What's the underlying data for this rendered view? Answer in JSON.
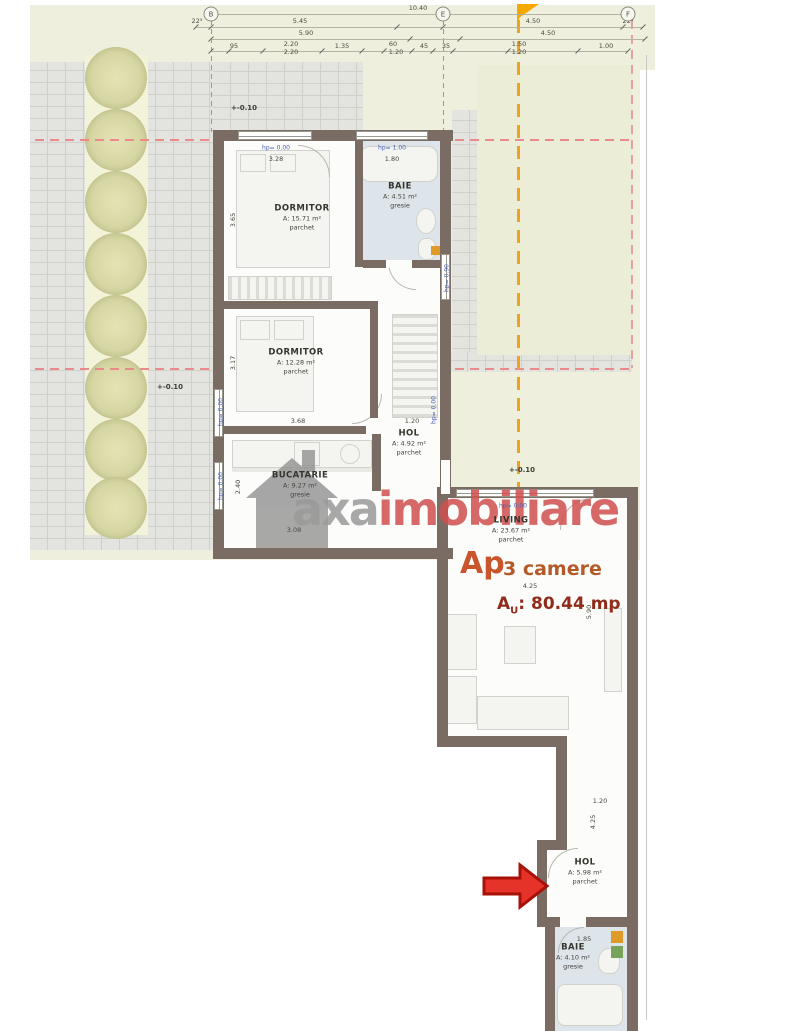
{
  "plan_title": "floor-plan",
  "apartment": {
    "name": "Ap",
    "rooms_count": "3 camere",
    "area_prefix": "A",
    "area_sub": "U",
    "area_value": ": 80.44 mp"
  },
  "watermark": {
    "gray_text": "axa",
    "red_text": "imobiliare"
  },
  "colors": {
    "accent_orange": "#f0a11e",
    "arrow_red": "#e5332a",
    "watermark_red": "#d0504e",
    "ap_label_orange": "#c8552b",
    "ap_area_brick": "#8f2c1c",
    "hp_label_blue": "#4a62b0",
    "dashed_red": "#e98b8b"
  },
  "grid_axes": [
    {
      "letter": "B",
      "x": 211,
      "y": 14
    },
    {
      "letter": "E",
      "x": 443,
      "y": 14
    },
    {
      "letter": "F",
      "x": 628,
      "y": 14
    }
  ],
  "top_dims": [
    {
      "text": "10.40",
      "x": 418,
      "y": 8
    },
    {
      "text": "22⁵",
      "x": 197,
      "y": 21
    },
    {
      "text": "5.45",
      "x": 300,
      "y": 21
    },
    {
      "text": "4.50",
      "x": 533,
      "y": 21
    },
    {
      "text": "22⁵",
      "x": 628,
      "y": 21
    },
    {
      "text": "5.90",
      "x": 306,
      "y": 33
    },
    {
      "text": "4.50",
      "x": 548,
      "y": 33
    },
    {
      "text": "95",
      "x": 234,
      "y": 46
    },
    {
      "text": "2.20",
      "x": 291,
      "y": 44
    },
    {
      "text": "2.20",
      "x": 291,
      "y": 52
    },
    {
      "text": "1.35",
      "x": 342,
      "y": 46
    },
    {
      "text": "60",
      "x": 393,
      "y": 44
    },
    {
      "text": "1.20",
      "x": 396,
      "y": 52
    },
    {
      "text": "45",
      "x": 424,
      "y": 46
    },
    {
      "text": "35",
      "x": 446,
      "y": 46
    },
    {
      "text": "1.50",
      "x": 519,
      "y": 44
    },
    {
      "text": "1.20",
      "x": 519,
      "y": 52
    },
    {
      "text": "1.00",
      "x": 606,
      "y": 46
    }
  ],
  "ticks": [
    {
      "y": 14,
      "xs": [
        211,
        443,
        628
      ]
    },
    {
      "y": 27,
      "xs": [
        196,
        211,
        397,
        443,
        623,
        643
      ]
    },
    {
      "y": 39,
      "xs": [
        211,
        410,
        460,
        645
      ]
    },
    {
      "y": 51,
      "xs": [
        211,
        229,
        263,
        322,
        362,
        384,
        412,
        433,
        453,
        508,
        578,
        628
      ]
    }
  ],
  "rooms": [
    {
      "name": "DORMITOR",
      "area": "A: 15.71 m²",
      "floor": "parchet",
      "x": 302,
      "y": 218
    },
    {
      "name": "BAIE",
      "area": "A: 4.51 m²",
      "floor": "gresie",
      "x": 400,
      "y": 196
    },
    {
      "name": "DORMITOR",
      "area": "A: 12.28 m²",
      "floor": "parchet",
      "x": 296,
      "y": 362
    },
    {
      "name": "HOL",
      "area": "A: 4.92 m²",
      "floor": "parchet",
      "x": 409,
      "y": 443
    },
    {
      "name": "BUCATARIE",
      "area": "A: 9.27 m²",
      "floor": "gresie",
      "x": 300,
      "y": 485
    },
    {
      "name": "LIVING",
      "area": "A: 23.67 m²",
      "floor": "parchet",
      "x": 511,
      "y": 530
    },
    {
      "name": "HOL",
      "area": "A: 5.98 m²",
      "floor": "parchet",
      "x": 585,
      "y": 872
    },
    {
      "name": "BAIE",
      "area": "A: 4.10 m²",
      "floor": "gresie",
      "x": 573,
      "y": 957
    }
  ],
  "dims": [
    {
      "text": "3.28",
      "x": 276,
      "y": 159
    },
    {
      "text": "1.80",
      "x": 392,
      "y": 159
    },
    {
      "text": "3.65",
      "x": 233,
      "y": 220,
      "rot": 1
    },
    {
      "text": "3.17",
      "x": 233,
      "y": 363,
      "rot": 1
    },
    {
      "text": "3.68",
      "x": 298,
      "y": 421
    },
    {
      "text": "1.20",
      "x": 412,
      "y": 421
    },
    {
      "text": "2.40",
      "x": 238,
      "y": 487,
      "rot": 1
    },
    {
      "text": "3.08",
      "x": 294,
      "y": 530
    },
    {
      "text": "4.25",
      "x": 530,
      "y": 586
    },
    {
      "text": "5.90",
      "x": 589,
      "y": 612,
      "rot": 1
    },
    {
      "text": "1.20",
      "x": 600,
      "y": 801
    },
    {
      "text": "4.25",
      "x": 593,
      "y": 822,
      "rot": 1
    },
    {
      "text": "1.85",
      "x": 584,
      "y": 939
    }
  ],
  "hp_labels": [
    {
      "text": "hp= 0.00",
      "x": 276,
      "y": 148
    },
    {
      "text": "hp= 1.00",
      "x": 392,
      "y": 148
    },
    {
      "text": "hp= 0.00",
      "x": 221,
      "y": 412,
      "rot": 1
    },
    {
      "text": "hp= 0.00",
      "x": 221,
      "y": 486,
      "rot": 1
    },
    {
      "text": "hp= 0.90",
      "x": 447,
      "y": 278,
      "rot": 1
    },
    {
      "text": "hp= 0.00",
      "x": 434,
      "y": 410,
      "rot": 1
    },
    {
      "text": "hp= 0.00",
      "x": 513,
      "y": 506
    }
  ],
  "elevation_markers": [
    {
      "symbol": "+",
      "text": "-0.10",
      "x": 244,
      "y": 108
    },
    {
      "symbol": "+",
      "text": "-0.10",
      "x": 170,
      "y": 387
    },
    {
      "symbol": "+",
      "text": "-0.10",
      "x": 522,
      "y": 470
    }
  ]
}
